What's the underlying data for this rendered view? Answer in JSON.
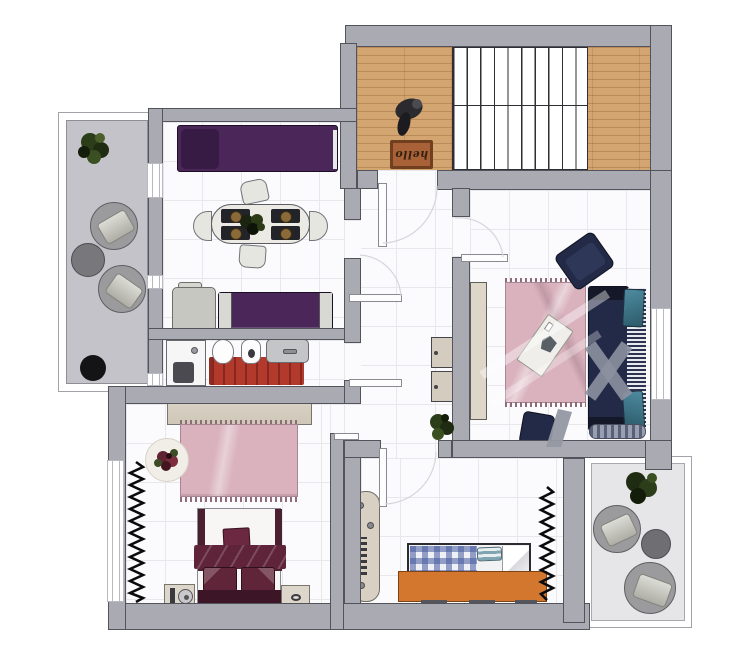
{
  "entry": {
    "doormat_text": "hello"
  },
  "colors": {
    "wall": "#a9aab2",
    "wall_line": "#53535c",
    "floor": "#fbfbfd",
    "grid": "#e7e7ec",
    "wood": "#d2a571",
    "stairs_line": "#2e2e33",
    "railing": "#ffffff",
    "balcony_left_floor": "#c3c3c9",
    "balcony_right_floor": "#e6e6e8",
    "purple": "#4a2758",
    "purple_dark": "#371b44",
    "navy": "#232a47",
    "navy_dark": "#141829",
    "teal": "#4e8ba0",
    "pink_rug": "#d9b2be",
    "pink_fringe": "#8d6b77",
    "red_mat": "#b23a2c",
    "orange_desk": "#d3772f",
    "beige": "#d8d1c3",
    "beige_dark": "#77756e",
    "burgundy": "#5f2439",
    "burgundy_dark": "#3c1626",
    "plaid_blue": "#5b6ca8",
    "green_plant": "#2c3d1a",
    "green_plant_dark": "#1c2a10",
    "white_furn": "#eceae4",
    "gray_furn": "#9b9b9d",
    "mat_brown": "#a96238",
    "mat_border": "#6f3f20",
    "mat_text": "#33200e",
    "watermark": "#8d92a0"
  },
  "rooms": [
    {
      "name": "entry-hall",
      "furniture": [
        "staircase",
        "doormat",
        "coat-hook"
      ]
    },
    {
      "name": "living-dining-room",
      "furniture": [
        "sofa",
        "chaise-section",
        "dining-table",
        "four-place-settings",
        "centerpiece-plant",
        "four-chairs",
        "loveseat",
        "gray-cabinet"
      ]
    },
    {
      "name": "hallway",
      "furniture": [
        "front-door",
        "storage-cabinets",
        "plant",
        "door-leaves"
      ]
    },
    {
      "name": "bathroom",
      "furniture": [
        "shower",
        "toilet",
        "bidet",
        "sink",
        "red-rug"
      ]
    },
    {
      "name": "living-room",
      "furniture": [
        "navy-sofa",
        "teal-pillows",
        "navy-armchair",
        "navy-chair",
        "coffee-table",
        "pink-rug",
        "tv-stand",
        "floor-runner"
      ]
    },
    {
      "name": "bedroom-main",
      "furniture": [
        "wardrobe",
        "double-bed",
        "two-nightstands",
        "pink-rug",
        "round-mat-with-flowers",
        "coat-rack",
        "window"
      ]
    },
    {
      "name": "bedroom-second",
      "furniture": [
        "single-bed-plaid",
        "orange-desk",
        "shelf-unit",
        "coat-rack"
      ]
    },
    {
      "name": "balcony-left",
      "furniture": [
        "two-lounge-chairs",
        "side-table",
        "plant",
        "black-pot"
      ]
    },
    {
      "name": "balcony-right",
      "furniture": [
        "two-lounge-chairs",
        "side-table",
        "plant"
      ]
    }
  ]
}
